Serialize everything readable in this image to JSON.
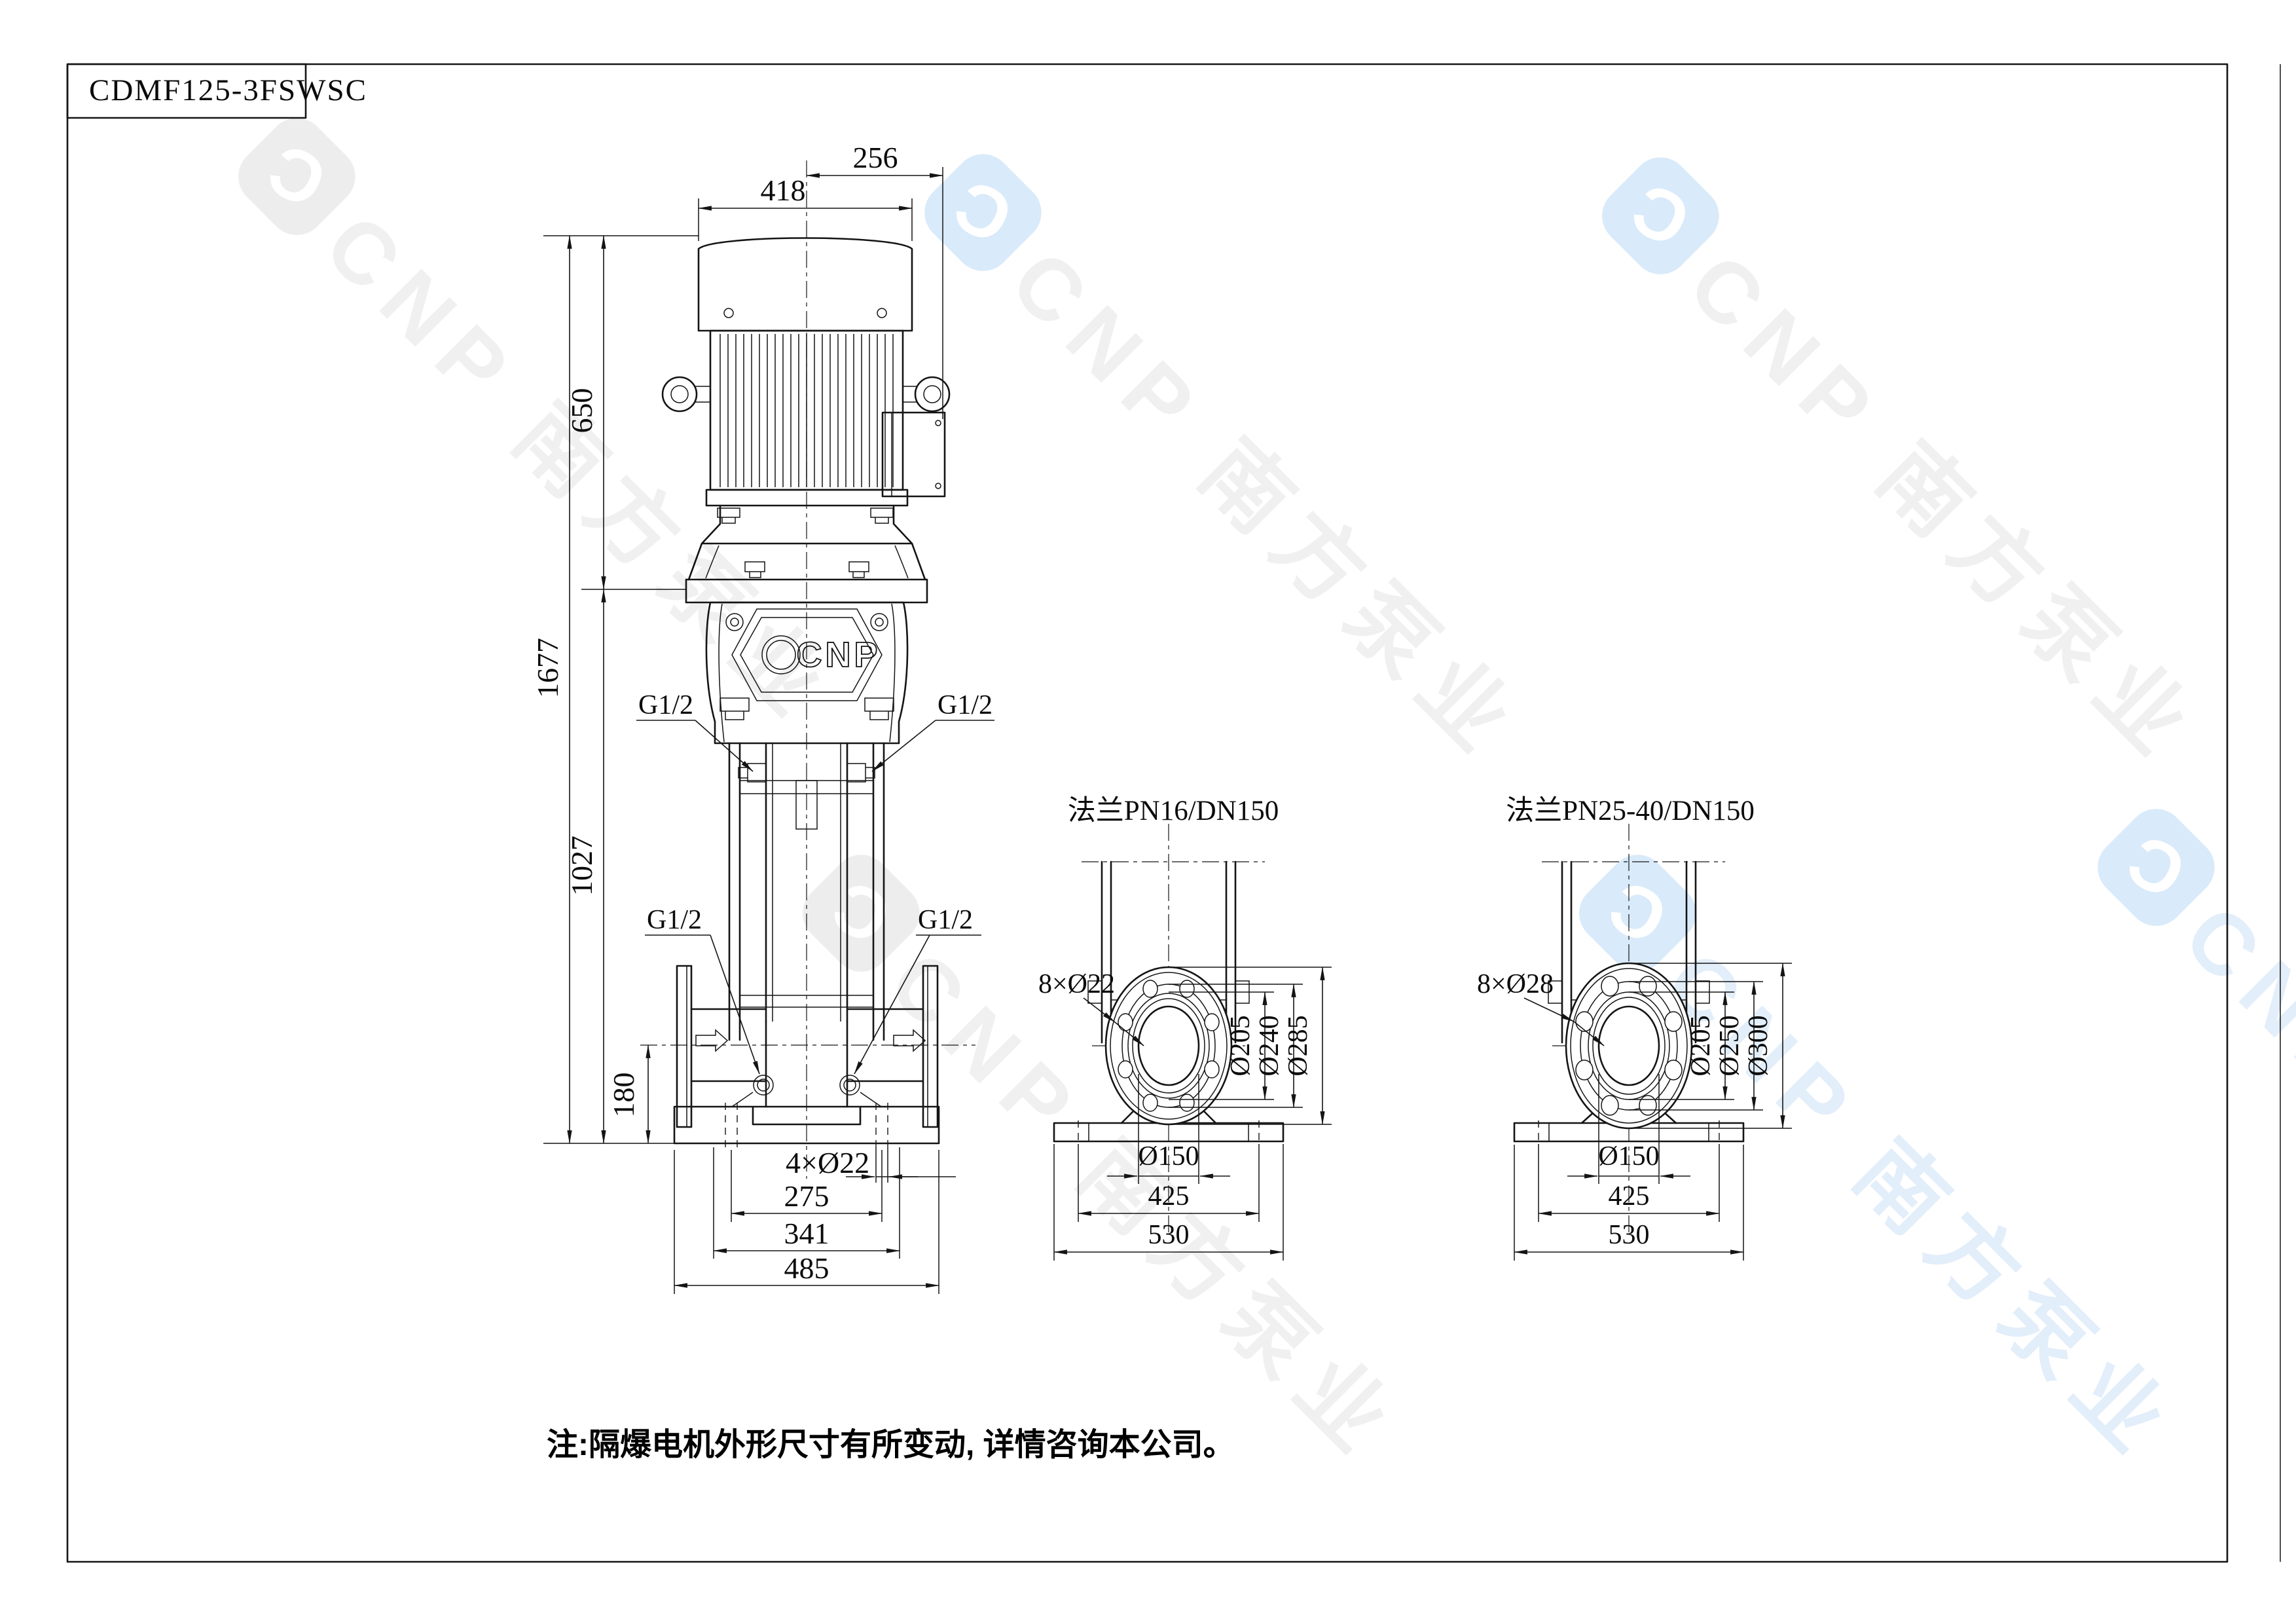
{
  "title_block": {
    "model": "CDMF125-3FSWSC"
  },
  "front": {
    "dim_418": "418",
    "dim_256": "256",
    "dim_650": "650",
    "dim_1677": "1677",
    "dim_1027": "1027",
    "dim_180": "180",
    "vent_left": "G1/2",
    "vent_right": "G1/2",
    "drain_left": "G1/2",
    "drain_right": "G1/2",
    "dim_holes": "4×Ø22",
    "dim_275": "275",
    "dim_341": "341",
    "dim_485": "485",
    "emblem": "CNP"
  },
  "flange1": {
    "title": "法兰PN16/DN150",
    "holes": "8×Ø22",
    "d_inner": "Ø205",
    "d_bolt": "Ø240",
    "d_outer": "Ø285",
    "d_port": "Ø150",
    "dim_425": "425",
    "dim_530": "530"
  },
  "flange2": {
    "title": "法兰PN25-40/DN150",
    "holes": "8×Ø28",
    "d_inner": "Ø205",
    "d_bolt": "Ø250",
    "d_outer": "Ø300",
    "d_port": "Ø150",
    "dim_425": "425",
    "dim_530": "530"
  },
  "note": "注:隔爆电机外形尺寸有所变动, 详情咨询本公司。",
  "watermark": {
    "logo_letter": "C",
    "text": "CNP 南方泵业"
  },
  "colors": {
    "line": "#141414",
    "watermark_blue": "#d9eafa",
    "watermark_gray": "#efefef"
  }
}
